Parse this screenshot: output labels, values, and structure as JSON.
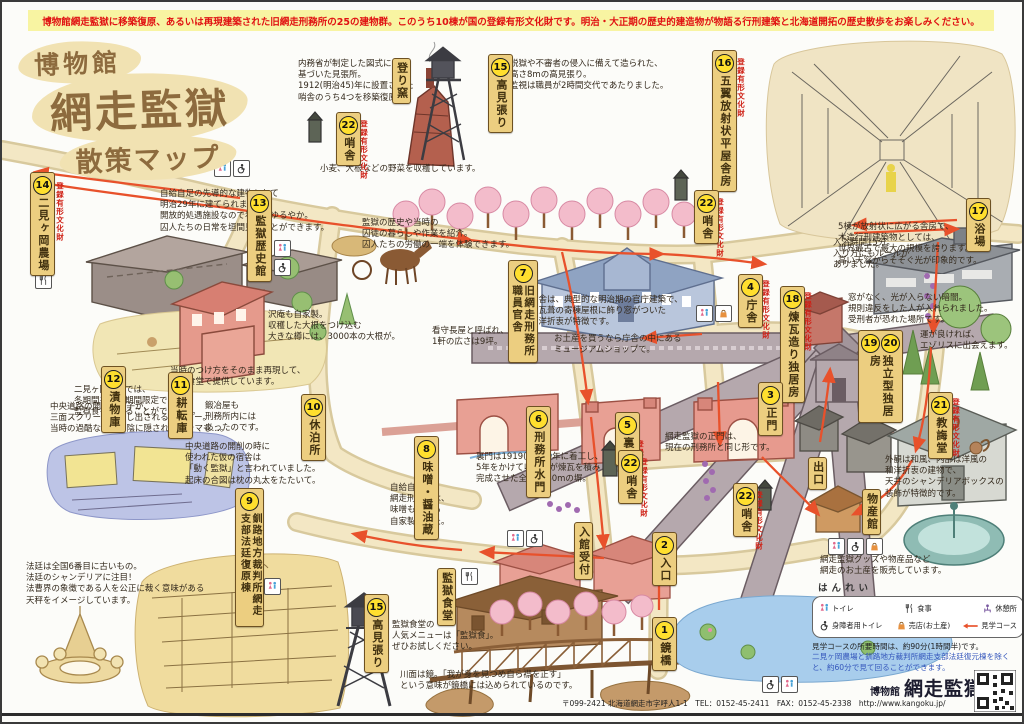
{
  "banner": {
    "text": "博物館網走監獄に移築復原、あるいは再現建築された旧網走刑務所の25の建物群。このうち10棟が国の登録有形文化財です。明治・大正期の歴史的建造物が物語る行刑建築と北海道開拓の歴史散歩をお楽しみください。"
  },
  "title": {
    "l1": "博物館",
    "l2": "網走監獄",
    "l3": "散策マップ"
  },
  "heritage": "登録有形文化財",
  "locations": [
    {
      "num": "1",
      "label": "鏡橋"
    },
    {
      "num": "2",
      "label": "入口"
    },
    {
      "num": "3",
      "label": "正門"
    },
    {
      "num": "4",
      "label": "庁舎",
      "heritage": true
    },
    {
      "num": "5",
      "label": "裏門",
      "heritage": true
    },
    {
      "num": "6",
      "label": "刑務所水門"
    },
    {
      "num": "7",
      "label": "旧網走刑務所職員官舎"
    },
    {
      "num": "8",
      "label": "味噌・醤油蔵"
    },
    {
      "num": "9",
      "label": "釧路地方裁判所網走支部法廷復原棟"
    },
    {
      "num": "10",
      "label": "休泊所"
    },
    {
      "num": "11",
      "label": "耕転庫"
    },
    {
      "num": "12",
      "label": "漬物庫"
    },
    {
      "num": "13",
      "label": "監獄歴史館"
    },
    {
      "num": "14",
      "label": "二見ヶ岡農場",
      "heritage": true
    },
    {
      "num": "15",
      "label": "高見張り"
    },
    {
      "num": "16",
      "label": "五翼放射状平屋舎房",
      "heritage": true
    },
    {
      "num": "17",
      "label": "浴場"
    },
    {
      "num": "18",
      "label": "煉瓦造り独居房",
      "heritage": true
    },
    {
      "num": "19",
      "num2": "20",
      "label": "独立型独居房"
    },
    {
      "num": "21",
      "label": "教誨堂",
      "heritage": true
    },
    {
      "num": "22",
      "label": "哨舎",
      "heritage": true
    }
  ],
  "facilities": {
    "noborigama": "登り窯",
    "reception": "入館受付",
    "exit": "出口",
    "bussankan": "物産館",
    "shokudo": "監獄食堂"
  },
  "notes": [
    "内務省が制定した図式に\n基づいた見張所。\n1912(明治45)年に設置された\n哨舎のうち4つを移築復原。",
    "脱獄や不審者の侵入に備えて造られた、\n高さ8mの高見張り。\n監視は職員が2時間交代であたりました。",
    "5棟が放射状に広がる舎房で、\n木造行刑建築物としては、\n世界最古で最大の規模を誇ります。\n高い天窓からそそぐ光が印象的です。",
    "自給自足の先導的な建物として\n明治29年に建てられました。\n開放的処遇施設なので看視もゆるやか。\n囚人たちの日常を垣間見ることができます。",
    "二見ヶ岡農場では、\n冬期間を除く期間限定で\n監獄食を食べることができます。",
    "小麦、大根などの野菜を収穫しています。",
    "監獄の歴史や当時の\n囚徒の暮らしや作業を紹介。\n囚人たちの労働の一端を体験できます。",
    "沢庵も自家製。\n収穫した大根をつけ込む\n大きな樽には、3000本の大根が。",
    "看守長屋と呼ばれ、\n1軒の広さは9坪。",
    "庁舎は、典型的な明治期の官庁建築で、\n総瓦葺の寄棟屋根に飾り窓がついた\n和洋折衷が特徴です。",
    "お土産を買うなら庁舎の中にある\nミュージアムショップで。",
    "当時のつけ方をそのまま再現して、\n監獄食堂で提供しています。",
    "鍛冶屋も\n刑務所内には\nあったのです。",
    "中央道路の開削の時に\n使われた仮の宿舎は\n「動く監獄」と言われていました。\n起床の合図は枕の丸太をたたいて。",
    "中央道路の開削の様子が、\n三面スクリーンに映し出されるシアター。\n当時の過酷な労働の陰に隠されたドラマも…。",
    "裏門は1919(大正8)年に着工し、\n5年をかけて収容者が煉瓦を積み\n完成させた全長1080mの塀。",
    "自給自足の\n網走刑務所は、\n味噌も醤油も\n自家製でした。",
    "入浴時間15分。\n入り方にもルールが\nありました。",
    "窓がなく、光が入らない暗闇。\n規則違反をした人が入れられました。\n受刑者が恐れた場所です。",
    "運が良ければ、\nエゾリスに出会えます。",
    "外観は和風、内部は洋風の\n和洋折衷の建物で、\n天井のシャンデリアボックスの\n装飾が特徴的です。",
    "網走監獄の正門は、\n現在の刑務所と同じ形です。",
    "網走監獄グッズや物産品など\n網走のお土産を販売しています。",
    "法廷は全国6番目に古いもの。\n法廷のシャンデリアに注目！\n法曹界の象徴である人を公正に裁く意味がある\n天秤をイメージしています。",
    "監獄食堂の\n人気メニューは「監獄食」。\nぜひお試しください。",
    "川面は鏡。「我が身を見つめ自ら襟を正す」\nという意味が鏡橋には込められているのです。"
  ],
  "legend": {
    "title": "はんれい",
    "items": [
      "トイレ",
      "食事",
      "休憩所",
      "身障者用トイレ",
      "売店(お土産)",
      "見学コース"
    ],
    "time1": "見学コースの所要時間は、約90分(1時間半)です。",
    "time2": "二見ヶ岡農場と釧路地方裁判所網走支部法廷復元棟を除くと、約60分で見て回ることができます。"
  },
  "footer": {
    "logo_small": "博物館",
    "logo_main": "網走監獄",
    "address": "〒099-2421 北海道網走市字呼人1-1　TEL：0152-45-2411　FAX：0152-45-2338　http://www.kangoku.jp/"
  },
  "colors": {
    "route": "#e8512b",
    "road": "#f3e7c4",
    "heritage_red": "#cf2015",
    "sign_wood": "#ecce80"
  }
}
